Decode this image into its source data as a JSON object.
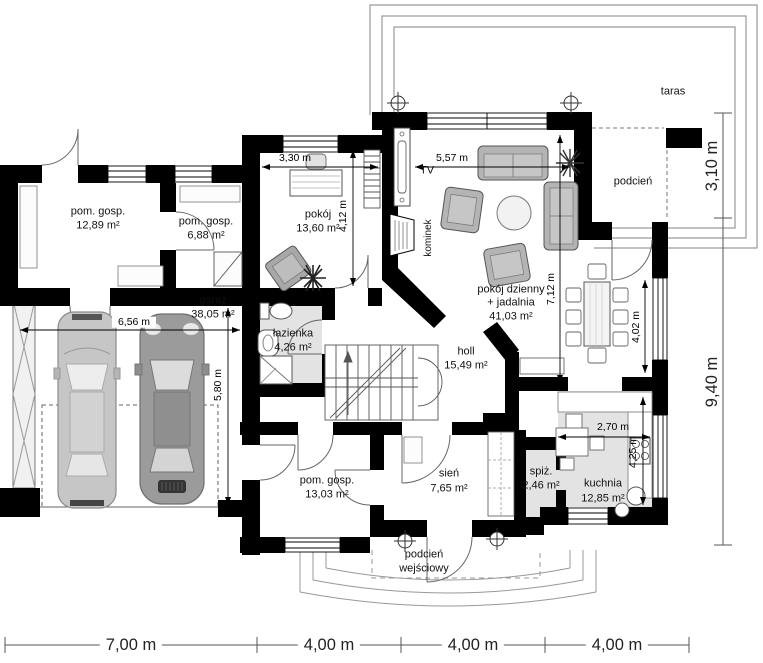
{
  "rooms": [
    {
      "name": "pom. gosp.",
      "area": "12,89 m²"
    },
    {
      "name": "pom. gosp.",
      "area": "6,88 m²"
    },
    {
      "name": "pokój",
      "area": "13,60 m²"
    },
    {
      "name": "garaż",
      "area": "38,05 m²"
    },
    {
      "name": "łazienka",
      "area": "4,26 m²"
    },
    {
      "name": "holl",
      "area": "15,49 m²"
    },
    {
      "name": "pokój dzienny",
      "line2": "+ jadalnia",
      "area": "41,03 m²"
    },
    {
      "name": "sień",
      "area": "7,65 m²"
    },
    {
      "name": "spiż.",
      "area": "2,46 m²"
    },
    {
      "name": "kuchnia",
      "area": "12,85 m²"
    },
    {
      "name": "pom. gosp.",
      "area": "13,03 m²"
    }
  ],
  "outdoor": {
    "taras": "taras",
    "podcien": "podcień",
    "podcien_wejsciowy_line1": "podcień",
    "podcien_wejsciowy_line2": "wejściowy"
  },
  "annotations": {
    "tv": "TV",
    "fireplace": "kominek"
  },
  "dimensions": {
    "pokoj_width": "3,30 m",
    "salon_width": "5,57 m",
    "pokoj_depth": "4,12 m",
    "salon_depth": "7,12 m",
    "jadalnia_depth": "4,02 m",
    "garaz_width": "6,56 m",
    "garaz_depth": "5,80 m",
    "kuchnia_width": "2,70 m",
    "kuchnia_depth": "4,25 m",
    "taras_depth": "3,10 m",
    "east_depth": "9,40 m",
    "bottom": [
      "7,00 m",
      "4,00 m",
      "4,00 m",
      "4,00 m"
    ]
  }
}
